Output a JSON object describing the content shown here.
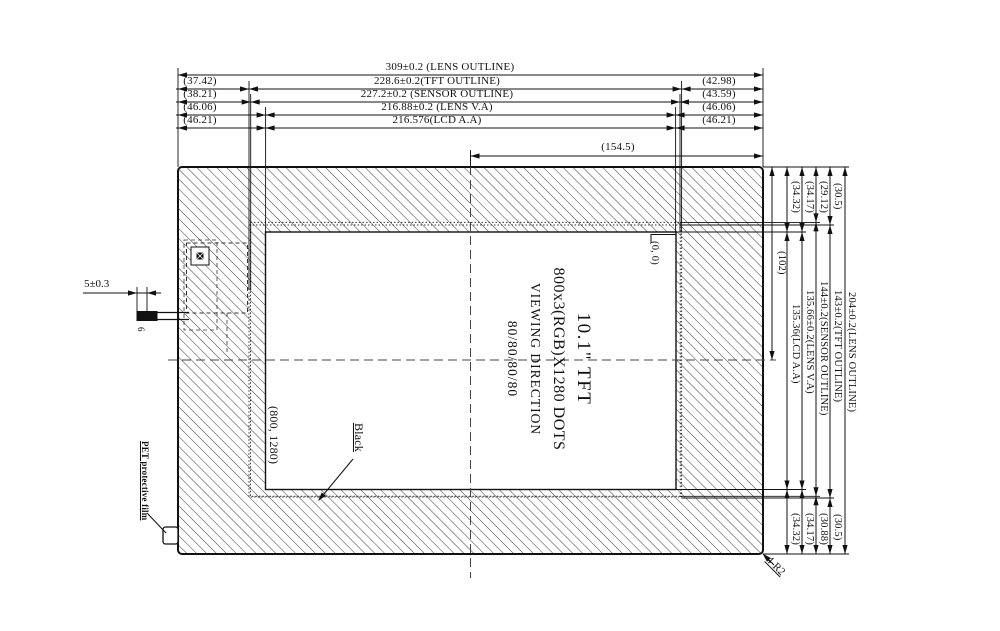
{
  "drawing": {
    "top_dims": [
      {
        "left": "",
        "mid": "309±0.2 (LENS OUTLINE)",
        "right": ""
      },
      {
        "left": "(37.42)",
        "mid": "228.6±0.2(TFT OUTLINE)",
        "right": "(42.98)"
      },
      {
        "left": "(38.21)",
        "mid": "227.2±0.2 (SENSOR OUTLINE)",
        "right": "(43.59)"
      },
      {
        "left": "(46.06)",
        "mid": "216.88±0.2 (LENS V.A)",
        "right": "(46.06)"
      },
      {
        "left": "(46.21)",
        "mid": "216.576(LCD A.A)",
        "right": "(46.21)"
      },
      {
        "left": "",
        "mid": "(154.5)",
        "right": ""
      }
    ],
    "right_dims": [
      {
        "top": "(34.32)",
        "mid": "135.36(LCD A.A)",
        "bottom": "(34.32)"
      },
      {
        "top": "(34.17)",
        "mid": "135.66±0.2(LENS V.A)",
        "bottom": "(34.17)"
      },
      {
        "top": "(29.12)",
        "mid": "144±0.2(SENSOR OUTLINE)",
        "bottom": "(30.88)"
      },
      {
        "top": "(30.5)",
        "mid": "143±0.2(TFT OUTLINE)",
        "bottom": "(30.5)"
      },
      {
        "top": "",
        "mid": "204±0.2(LENS OUTLINE)",
        "bottom": ""
      }
    ],
    "half_height": "(102)",
    "fpc": {
      "width_dim": "5±0.3",
      "mark": "6"
    },
    "labels": {
      "origin": "(0, 0)",
      "resolution": "(800, 1280)",
      "black": "Black",
      "pet_film": "PET protective film",
      "corner_radius": "4-R2"
    },
    "panel": {
      "size": "10.1\" TFT",
      "dots": "800x3(RGB)X1280 DOTS",
      "viewing": "VIEWING DIRECTION",
      "viewing_angles": "80/80/80/80"
    },
    "colors": {
      "line": "#111111",
      "background": "#ffffff"
    }
  }
}
